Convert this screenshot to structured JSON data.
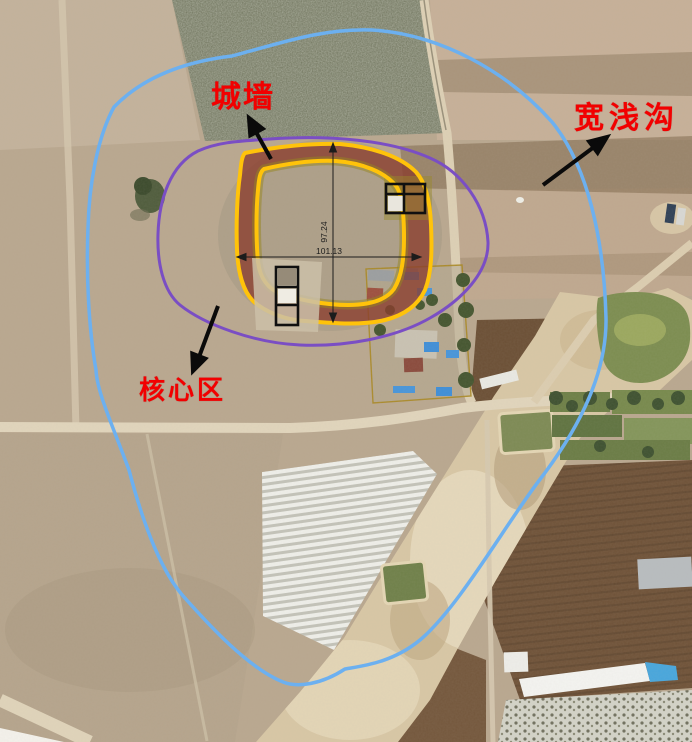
{
  "figure": {
    "type": "annotated-aerial-photo",
    "annotations": {
      "wall_label": "城墙",
      "ditch_label": "宽浅沟",
      "core_label": "核心区"
    },
    "dimensions": {
      "width_m": "101.13",
      "height_m": "97.24"
    },
    "colors": {
      "ditch_outline": "#6cb0f0",
      "core_outline": "#7a4ec4",
      "wall_edge": "#ffc30a",
      "wall_fill": "#8b3d2e",
      "trench_outline": "#101010",
      "label_text": "#f20000"
    }
  }
}
